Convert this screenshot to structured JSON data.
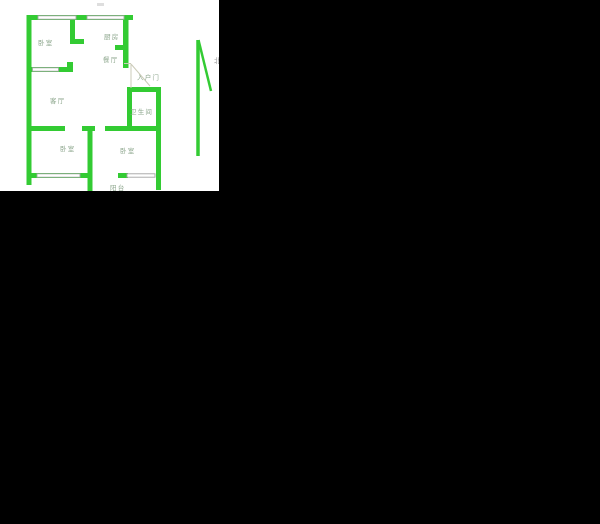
{
  "floorplan": {
    "rooms": [
      {
        "id": "bedroom-top-left",
        "label": "卧室"
      },
      {
        "id": "kitchen",
        "label": "厨房"
      },
      {
        "id": "dining-room",
        "label": "餐厅"
      },
      {
        "id": "entrance-door",
        "label": "入户门"
      },
      {
        "id": "living-room",
        "label": "客厅"
      },
      {
        "id": "bathroom",
        "label": "卫生间"
      },
      {
        "id": "bedroom-bottom-left",
        "label": "卧室"
      },
      {
        "id": "bedroom-bottom-right",
        "label": "卧室"
      },
      {
        "id": "balcony",
        "label": "阳台"
      }
    ],
    "compass": {
      "label": "北"
    },
    "colors": {
      "wall_green": "#33cb33",
      "room_label": "#8ca68c",
      "window_frame": "#a3a3a3",
      "door_swing": "#cbcbb8",
      "panel_background": "#ffffff",
      "canvas_background": "#000000"
    }
  }
}
